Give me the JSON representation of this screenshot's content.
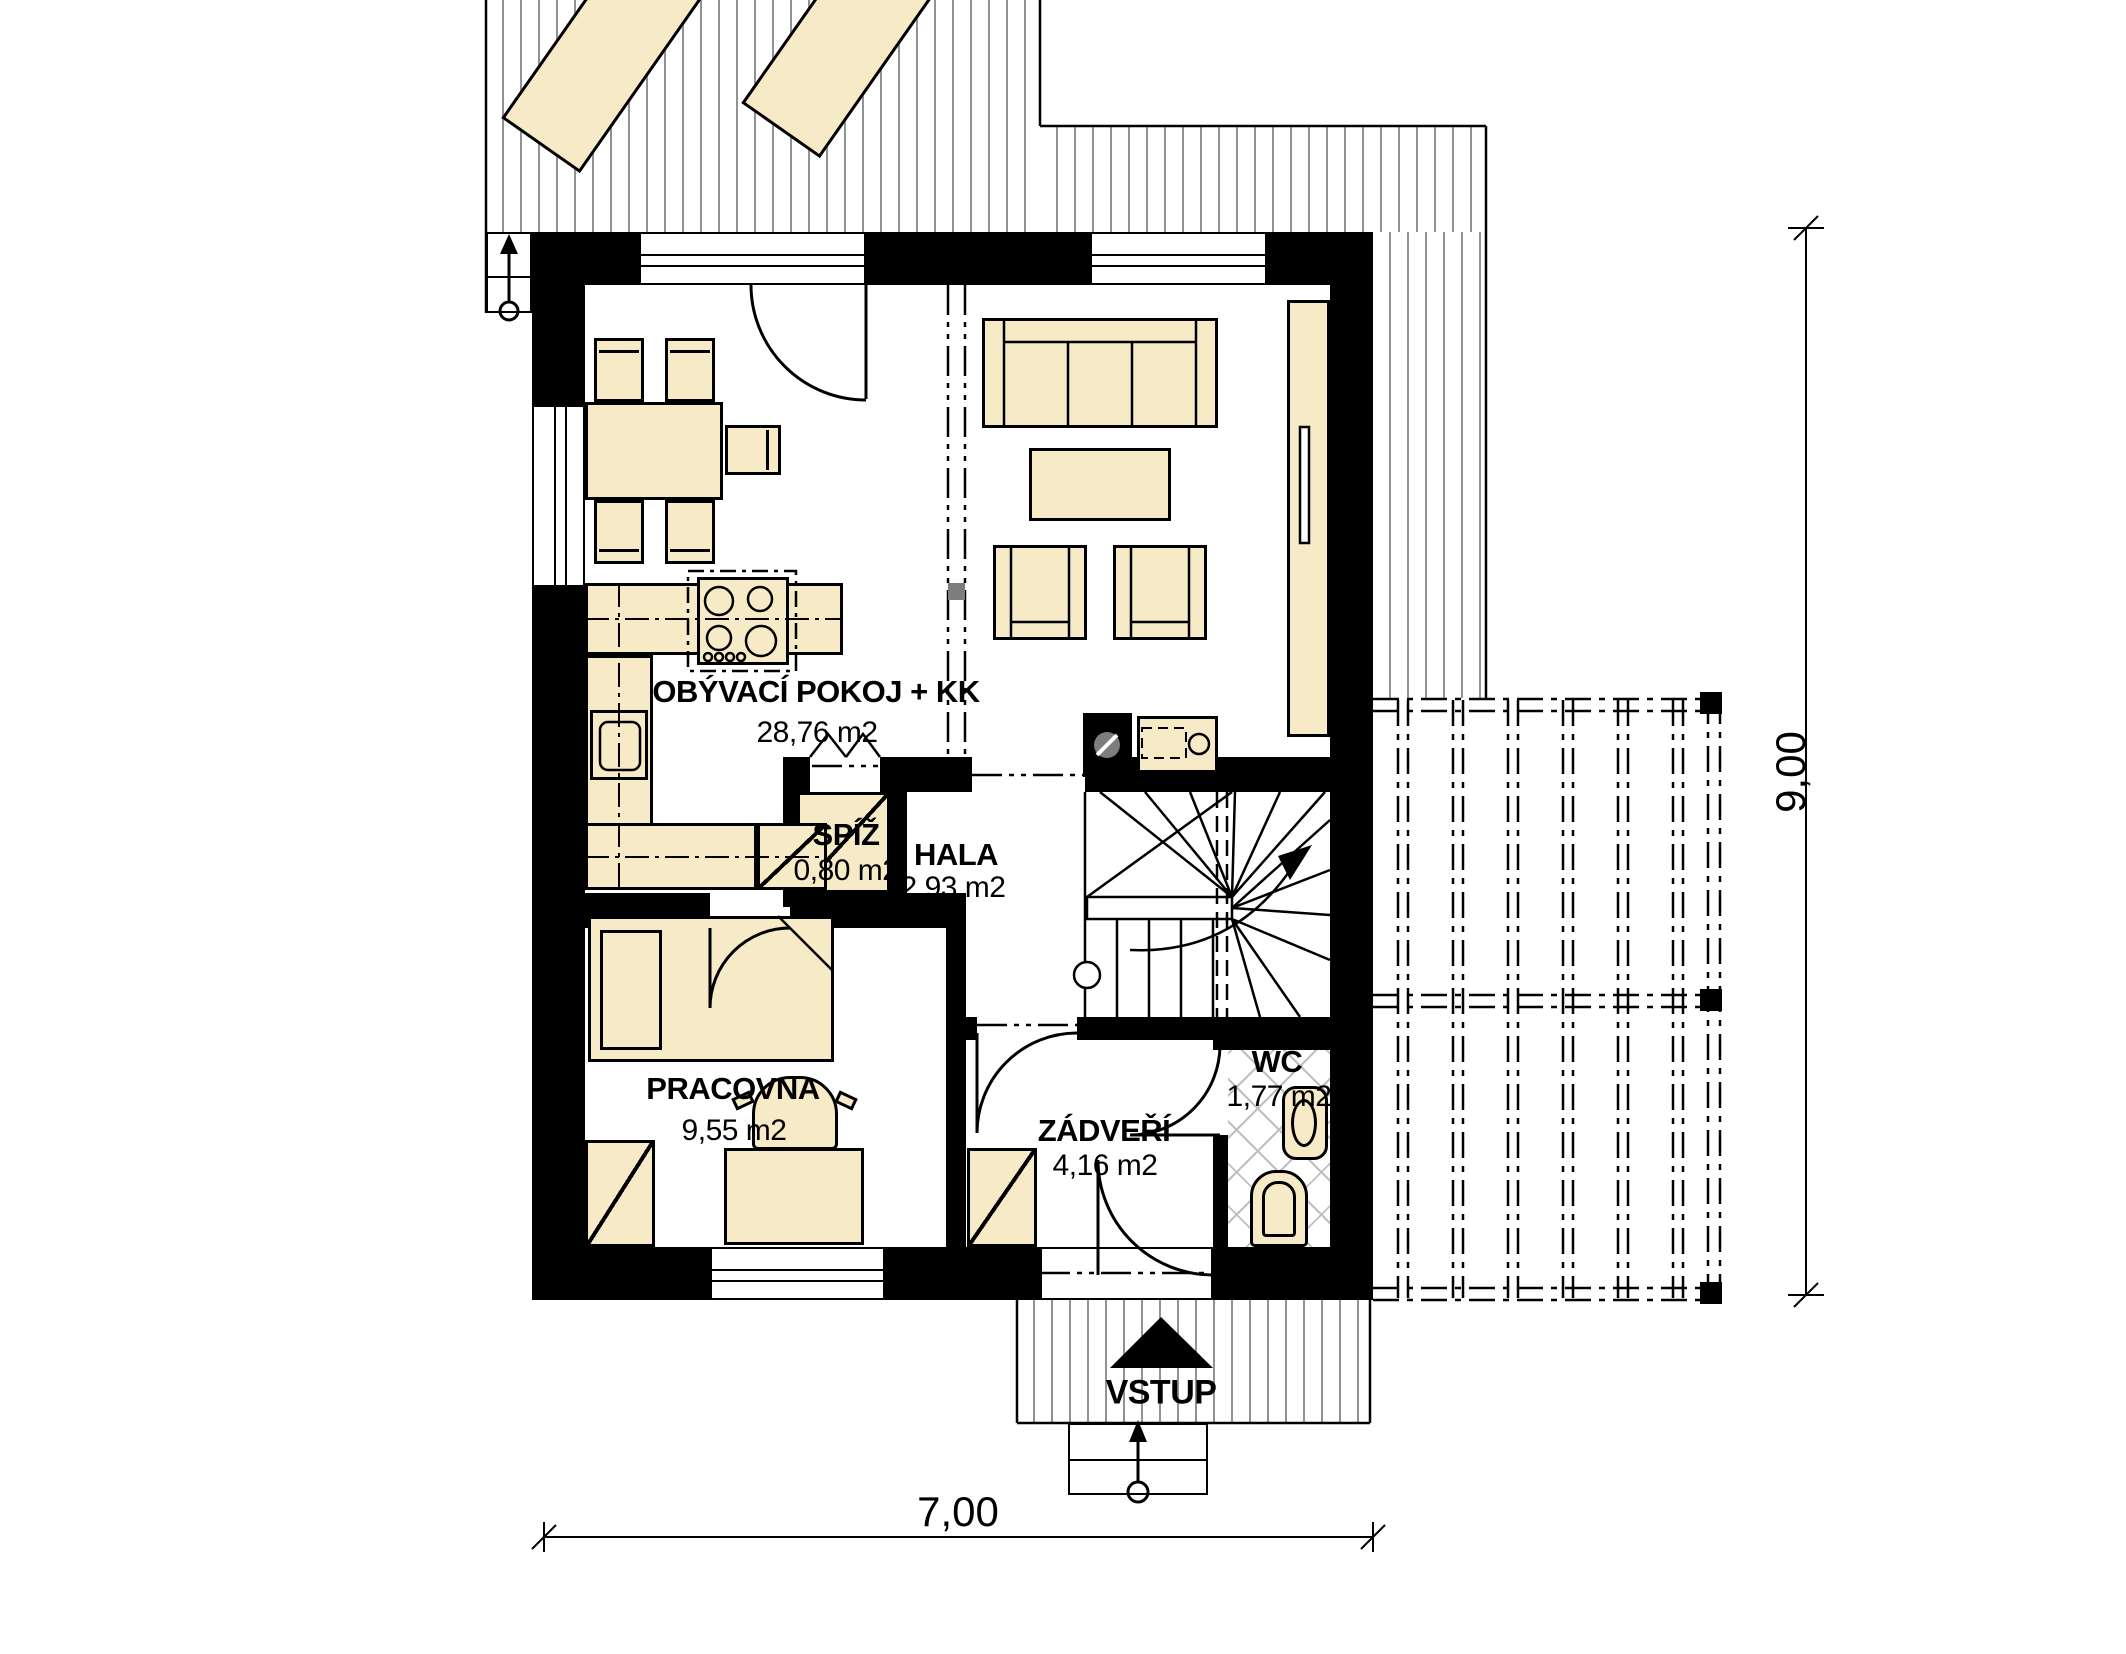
{
  "plan": {
    "rooms": {
      "living": {
        "name": "OBÝVACÍ POKOJ + KK",
        "area": "28,76 m2"
      },
      "pantry": {
        "name": "SPÍŽ",
        "area": "0,80 m2"
      },
      "hall": {
        "name": "HALA",
        "area": "2,93 m2"
      },
      "study": {
        "name": "PRACOVNA",
        "area": "9,55 m2"
      },
      "vestibule": {
        "name": "ZÁDVEŘÍ",
        "area": "4,16 m2"
      },
      "wc": {
        "name": "WC",
        "area": "1,77 m2"
      }
    },
    "entrance_label": "VSTUP",
    "dimensions": {
      "width_m": "7,00",
      "height_m": "9,00"
    },
    "colors": {
      "furniture_fill": "#F6EBC6",
      "wall": "#000000",
      "hatch_line": "#929292",
      "tile_line": "#BFBFBF",
      "marker": "#7D7D7D"
    }
  }
}
